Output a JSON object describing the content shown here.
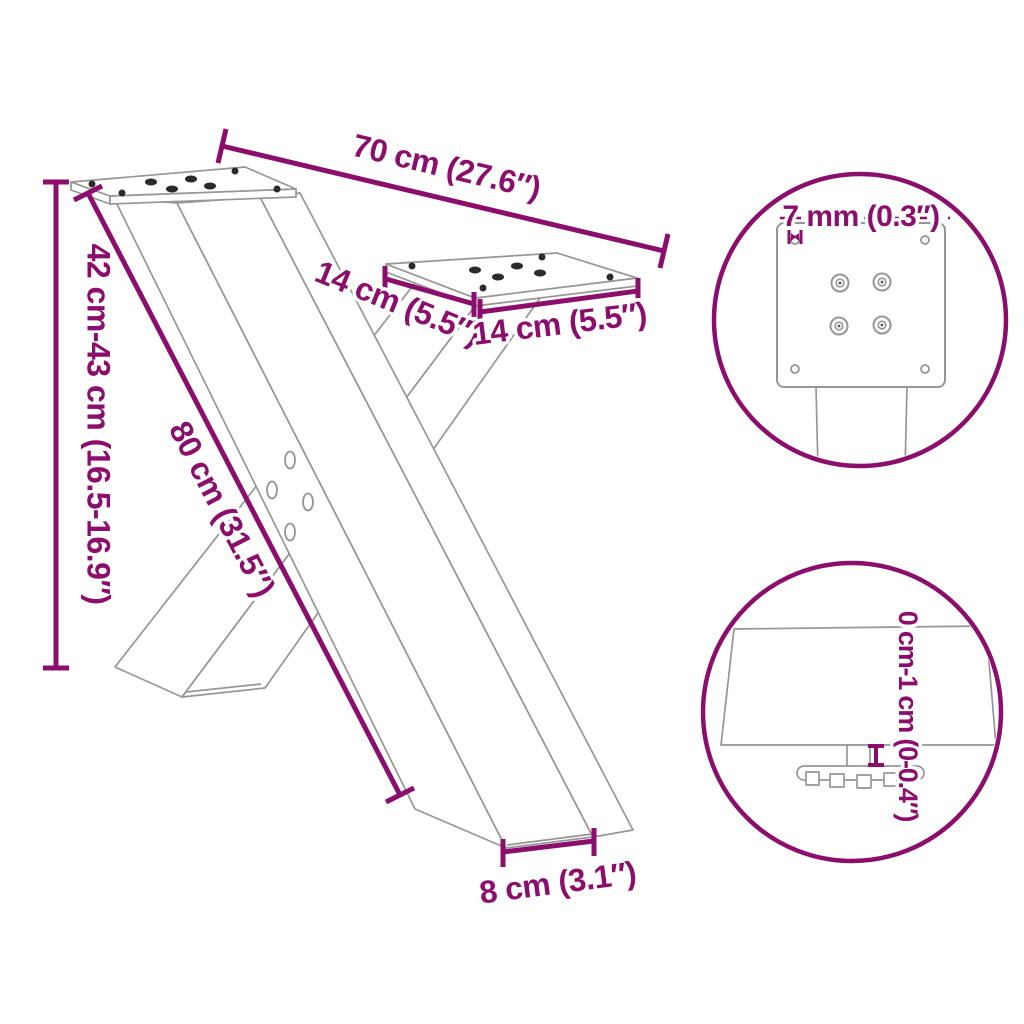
{
  "labels": {
    "top_width": "70 cm (27.6″)",
    "height_range": "42 cm-43 cm (16.5-16.9″)",
    "leg_length": "80 cm (31.5″)",
    "plate_depth": "14 cm (5.5″)",
    "plate_width": "14 cm (5.5″)",
    "foot_width": "8 cm (3.1″)",
    "plate_thickness": "7 mm (0.3″)",
    "leveler_range": "0 cm-1 cm (0-0.4″)"
  },
  "icons": {
    "thickness": "thickness-arrows-icon",
    "height_adjust": "height-adjust-icon"
  },
  "colors": {
    "accent": "#8B0E6C",
    "outline": "#969696",
    "hole": "#2b2b2b",
    "background": "#ffffff"
  }
}
